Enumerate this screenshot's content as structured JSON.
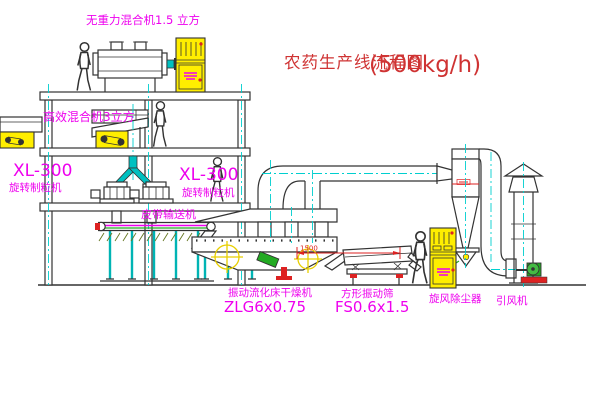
{
  "title": {
    "name": "农药生产线流程图",
    "capacity": "(500kg/h)"
  },
  "labels": {
    "mixer_top": "无重力混合机1.5 立方",
    "mixer_high_efficiency": "高效混合机3立方",
    "granulator_left_model": "XL-300",
    "granulator_left_name": "旋转制粒机",
    "granulator_center_model": "XL-300",
    "granulator_center_name": "旋转制粒机",
    "belt_conveyor": "皮带输送机",
    "fluid_bed_dryer_name": "振动流化床干燥机",
    "fluid_bed_dryer_model": "ZLG6x0.75",
    "vibrating_screen_name": "方形振动筛",
    "vibrating_screen_model": "FS0.6x1.5",
    "cyclone_dust_collector": "旋风除尘器",
    "induced_draft_fan": "引风机",
    "dimension_1500": "1500"
  },
  "colors": {
    "title_red": "#cf3333",
    "label_magenta": "#ee00ee",
    "dimension_red": "#dd2222",
    "line_dark": "#333333",
    "centerline_cyan": "#00cfcf",
    "cabinet_yellow": "#ffee00",
    "machine_green": "#22aa22",
    "background": "#ffffff"
  }
}
